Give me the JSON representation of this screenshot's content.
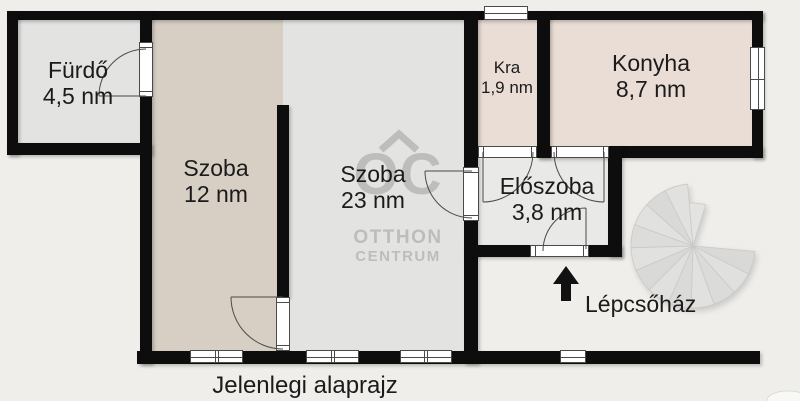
{
  "title_caption": "Jelenlegi alaprajz",
  "rooms": [
    {
      "id": "furdo",
      "name": "Fürdő",
      "area": "4,5 nm"
    },
    {
      "id": "szoba12",
      "name": "Szoba",
      "area": "12 nm"
    },
    {
      "id": "szoba23",
      "name": "Szoba",
      "area": "23 nm"
    },
    {
      "id": "kra",
      "name": "Kra",
      "area": "1,9 nm"
    },
    {
      "id": "konyha",
      "name": "Konyha",
      "area": "8,7 nm"
    },
    {
      "id": "eloszoba",
      "name": "Előszoba",
      "area": "3,8 nm"
    }
  ],
  "stairwell": {
    "label": "Lépcsőház"
  },
  "watermark": {
    "logo": "OC",
    "line1": "OTTHON",
    "line2": "CENTRUM"
  },
  "colors": {
    "bg": "#f0eeea",
    "wall": "#0d0d0d",
    "floor-gray": "#e3e3e2",
    "floor-gray-light": "#e9e9e8",
    "floor-beige": "#d7cfc4",
    "floor-beige-light": "#e9ddd5",
    "watermark": "#bdbdbb",
    "ink": "#1b1b1b",
    "frame": "#4a4a4a"
  }
}
